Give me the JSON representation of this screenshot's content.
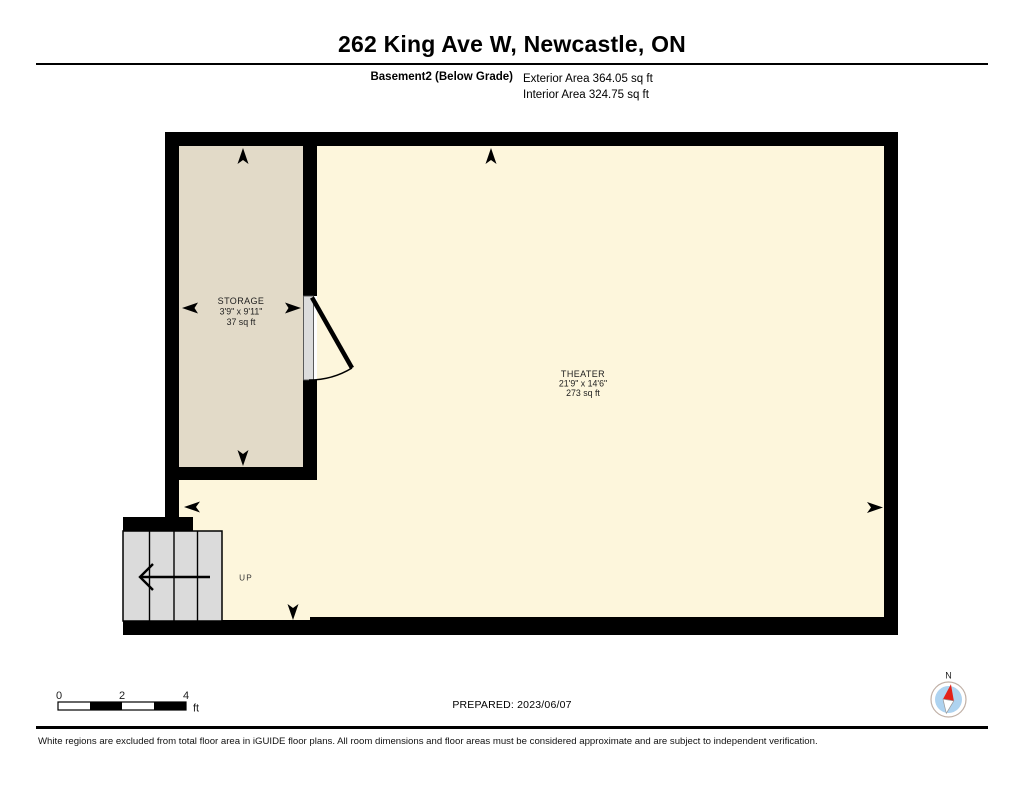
{
  "header": {
    "title": "262 King Ave W, Newcastle, ON",
    "floor_label": "Basement2 (Below Grade)",
    "exterior_area": "Exterior Area 364.05 sq ft",
    "interior_area": "Interior Area 324.75 sq ft"
  },
  "rooms": {
    "storage": {
      "name": "STORAGE",
      "dimensions": "3'9\" x 9'11\"",
      "area": "37 sq ft"
    },
    "theater": {
      "name": "THEATER",
      "dimensions": "21'9\" x 14'6\"",
      "area": "273 sq ft"
    }
  },
  "stairs": {
    "label": "UP"
  },
  "scale_bar": {
    "tick_0": "0",
    "tick_2": "2",
    "tick_4": "4",
    "unit": "ft"
  },
  "prepared": "PREPARED: 2023/06/07",
  "compass": {
    "north_label": "N"
  },
  "footer": {
    "disclaimer": "White regions are excluded from total floor area in iGUIDE floor plans. All room dimensions and floor areas must be considered approximate and are subject to independent verification."
  },
  "colors": {
    "wall": "#000000",
    "storage_fill": "#e2dac8",
    "theater_fill": "#fdf6dc",
    "stairs_fill": "#dbdbdb",
    "door_fill": "#dcdcdc",
    "compass_blue": "#aed3f0",
    "compass_red": "#e32119"
  }
}
